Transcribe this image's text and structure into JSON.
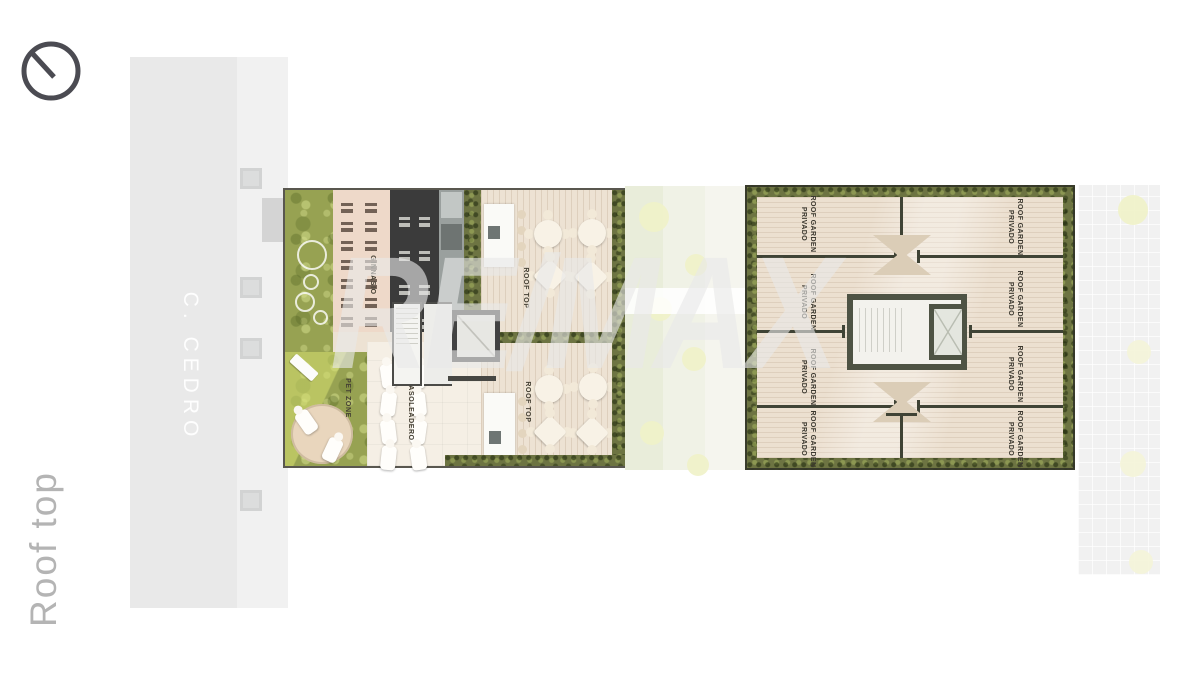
{
  "floor": {
    "label": "Roof top"
  },
  "street": {
    "name": "C. CEDRO"
  },
  "watermark": {
    "text": "RE/MAX"
  },
  "icons": {
    "orientation_dial": "circle-with-needle"
  },
  "amenities_building": {
    "rooms": {
      "gym": "GINNASIO",
      "pet_zone": "PET ZONE",
      "sunbathing": "ASOLEADERO",
      "rooftop_upper": "ROOF TOP",
      "rooftop_lower": "ROOF TOP"
    }
  },
  "private_building": {
    "panels": [
      {
        "line1": "ROOF GARDEN",
        "line2": "PRIVADO"
      },
      {
        "line1": "ROOF GARDEN",
        "line2": "PRIVADO"
      },
      {
        "line1": "ROOF GARDEN",
        "line2": "PRIVADO"
      },
      {
        "line1": "ROOF GARDEN",
        "line2": "PRIVADO"
      },
      {
        "line1": "ROOF GARDEN",
        "line2": "PRIVADO"
      },
      {
        "line1": "ROOF GARDEN",
        "line2": "PRIVADO"
      },
      {
        "line1": "ROOF GARDEN",
        "line2": "PRIVADO"
      },
      {
        "line1": "ROOF GARDEN",
        "line2": "PRIVADO"
      }
    ]
  },
  "colors": {
    "background": "#ffffff",
    "street": "#e9e9e9",
    "grass": "#97a252",
    "hedge": "#6d7442",
    "deck_wood": "#ede2d3",
    "gym_floor": "#eed9c9",
    "dark_room": "#3b3b3b",
    "core_wall": "#4e5344",
    "plan_label_text": "#3b382f",
    "side_label_text": "#b4b4b4",
    "watermark_text": "#e8e8e8"
  }
}
